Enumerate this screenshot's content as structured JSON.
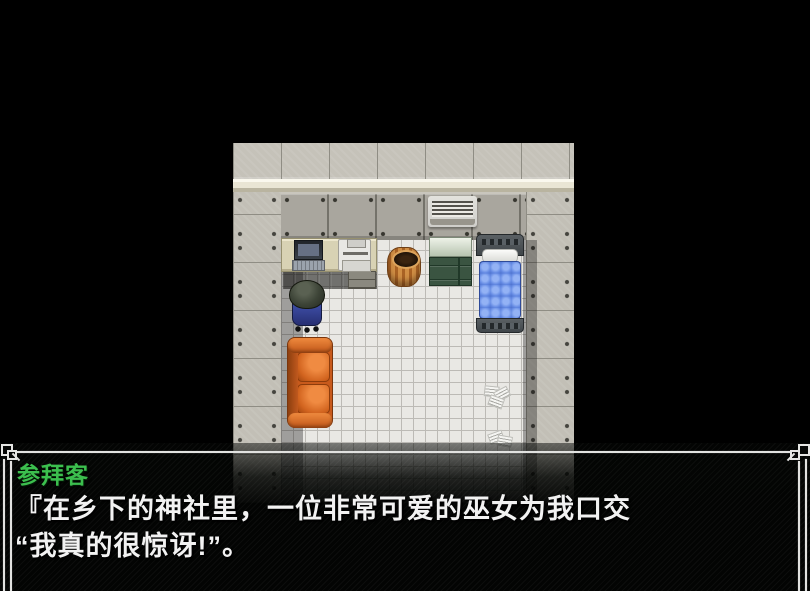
{
  "dialogue": {
    "speaker": "参拜客",
    "speaker_color": "#3cbf4e",
    "lines": [
      "『在乡下的神社里，一位非常可爱的巫女为我口交",
      "“我真的很惊讶!”。"
    ],
    "text_color": "#f2f2f2",
    "window_border_color": "#e2e2e0",
    "window_background": "#030403"
  },
  "scene": {
    "type": "rpg-maker-interior-map",
    "objects": [
      "stone-wall-top",
      "white-wall-trim",
      "metal-panel-wall",
      "tile-floor",
      "air-conditioner",
      "desk",
      "laptop",
      "printer",
      "waste-basket",
      "green-cabinet",
      "blue-bed",
      "character-on-office-chair",
      "orange-sofa",
      "scattered-papers"
    ],
    "colors": {
      "background": "#000000",
      "wall_stone": "#c5c2b9",
      "wall_metal": "#a9a69e",
      "floor_tile": "#e9e8e4",
      "bed_blanket": "#4f74d2",
      "sofa": "#c85a1c",
      "cabinet": "#3a5441",
      "basket": "#c07a35"
    }
  }
}
